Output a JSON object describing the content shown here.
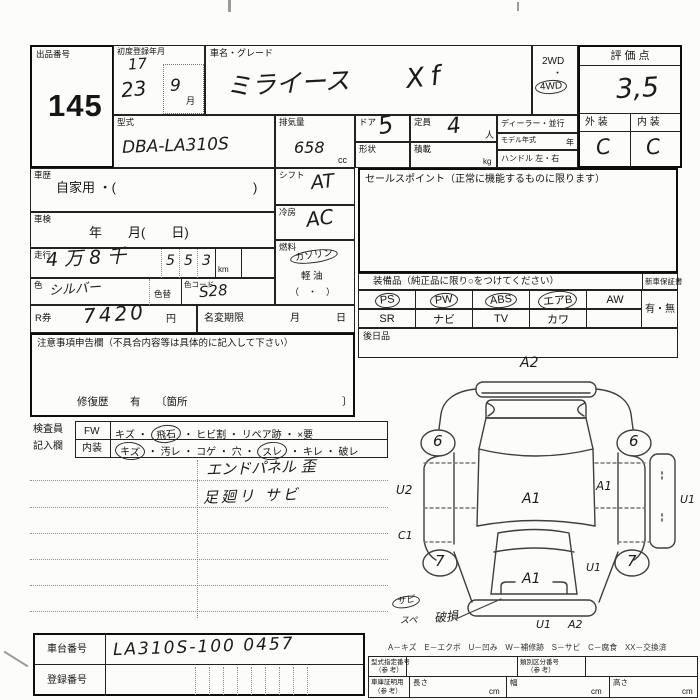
{
  "header": {
    "auction_no_label": "出品番号",
    "auction_no": "145",
    "first_reg_label": "初度登録年月",
    "first_reg_note": "17",
    "first_reg_year": "23",
    "first_reg_month": "9",
    "month_unit": "月",
    "car_name_label": "車名・グレード",
    "car_name": "ミライース",
    "grade": "Xf",
    "drive_2wd": "2WD",
    "drive_sep": "・",
    "drive_4wd": "4WD",
    "score_label": "評 価 点",
    "score": "3,5",
    "exterior_label": "外 装",
    "interior_label": "内 装",
    "exterior_grade": "C",
    "interior_grade": "C"
  },
  "vehicle": {
    "model_label": "型式",
    "model": "DBA-LA310S",
    "displacement_label": "排気量",
    "displacement": "658",
    "displacement_unit": "cc",
    "doors_label": "ドア",
    "doors": "5",
    "capacity_label": "定員",
    "capacity": "4",
    "capacity_unit": "人",
    "shape_label": "形状",
    "load_label": "積載",
    "load_unit": "kg",
    "dealer_label": "ディーラー・並行",
    "model_year_label": "モデル年式",
    "model_year_unit": "年",
    "handle_label": "ハンドル 左・右",
    "history_label": "車歴",
    "history_value": "自家用 ・(",
    "history_close": ")",
    "shaken_label": "車検",
    "shaken_value": "年　　月(　　日)",
    "mileage_label": "走行",
    "mileage_hw": "4万8千",
    "mileage_d1": "5",
    "mileage_d2": "5",
    "mileage_d3": "3",
    "mileage_unit": "km",
    "color_label": "色",
    "color": "シルバー",
    "color_change_label": "色替",
    "color_code_label": "色コード",
    "color_code": "S28",
    "shift_label": "シフト",
    "shift": "AT",
    "ac_label": "冷房",
    "ac": "AC",
    "fuel_label": "燃料",
    "fuel_gasoline": "ガソリン",
    "fuel_diesel": "軽 油",
    "fuel_paren": "（　・　）"
  },
  "sales_point": {
    "label": "セールスポイント（正常に機能するものに限ります）"
  },
  "equipment": {
    "label": "装備品（純正品に限り○をつけてください）",
    "row1": [
      "PS",
      "PW",
      "ABS",
      "エアB",
      "AW"
    ],
    "row2": [
      "SR",
      "ナビ",
      "TV",
      "カワ"
    ],
    "warranty_label": "新車保証書",
    "warranty_value": "有・無",
    "later_label": "後日品"
  },
  "payment": {
    "r_label": "R券",
    "r_amount": "7420",
    "r_unit": "円",
    "name_change_label": "名変期限",
    "month_label": "月",
    "day_label": "日"
  },
  "caution": {
    "header": "注意事項申告欄（不具合内容等は具体的に記入して下さい）",
    "repair_label": "修復歴",
    "repair_value": "有",
    "repair_open": "〔箇所",
    "repair_close": "〕"
  },
  "inspector": {
    "label_line1": "検査員",
    "label_line2": "記入欄",
    "sep": "・",
    "fw_label": "FW",
    "fw_items": [
      "キズ",
      "飛石",
      "ヒビ割",
      "リペア跡",
      "×要"
    ],
    "interior_label": "内装",
    "interior_items": [
      "キズ",
      "汚レ",
      "コゲ",
      "穴",
      "スレ",
      "キレ",
      "破レ"
    ],
    "note1": "エンドパネル 歪",
    "note2": "足廻リ サビ"
  },
  "diagram": {
    "a2_top": "A2",
    "wheel_front_left": "6",
    "wheel_front_right": "6",
    "u2_left": "U2",
    "a1_right": "A1",
    "u1_right": "U1",
    "a1_center": "A1",
    "c1_left": "C1",
    "wheel_rear_left": "7",
    "wheel_rear_right": "7",
    "u1_mid": "U1",
    "a1_rear": "A1",
    "note_circled": "サビ",
    "note_under": "スペ",
    "damage_note": "破損",
    "u1_bottom": "U1",
    "a2_bottom": "A2",
    "legend": "A－キズ　E－エクボ　U－凹み　W－補修跡　S－サビ　C－腐食　XX－交換済"
  },
  "bottom": {
    "chassis_label": "車台番号",
    "chassis_no": "LA310S-100 0457",
    "reg_no_label": "登録番号",
    "type_no_label": "型式指定番号",
    "ref1": "（参 考）",
    "class_no_label": "類別区分番号",
    "ref2": "（参 考）",
    "garage_label": "車庫証明用",
    "ref3": "（参 考）",
    "length_label": "長さ",
    "width_label": "幅",
    "height_label": "高さ",
    "cm1": "cm",
    "cm2": "cm",
    "cm3": "cm"
  }
}
